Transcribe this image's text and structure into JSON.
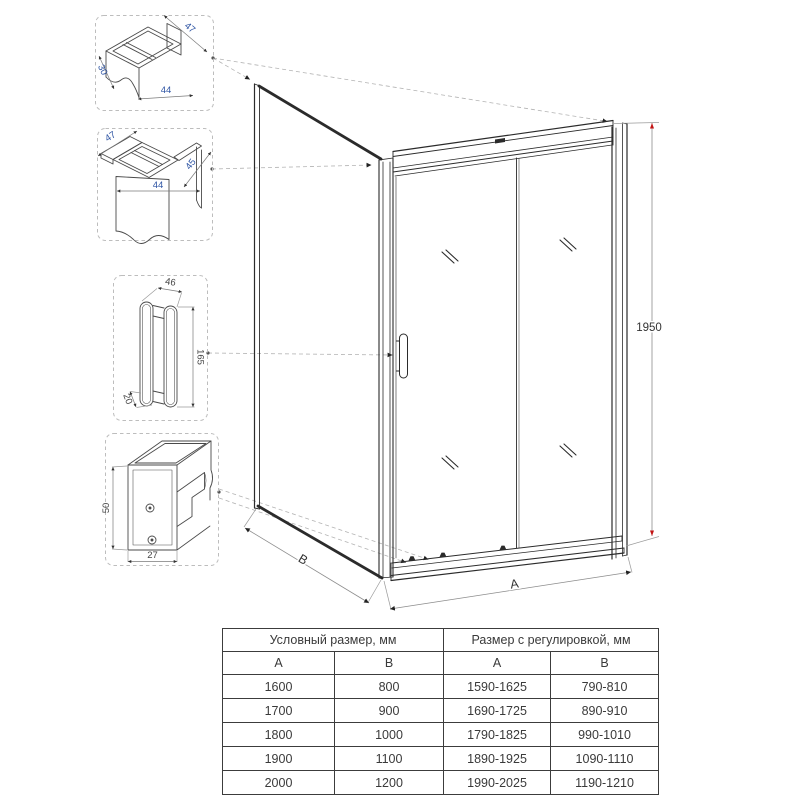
{
  "details": {
    "top_profile": {
      "dims": [
        "47",
        "30",
        "44"
      ]
    },
    "corner_profile": {
      "dims": [
        "47",
        "44",
        "45"
      ]
    },
    "handle": {
      "dims": [
        "46",
        "165",
        "20"
      ]
    },
    "bottom_rail": {
      "dims": [
        "50",
        "27"
      ]
    }
  },
  "drawing": {
    "height_label": "1950",
    "width_label": "A",
    "depth_label": "B",
    "accent_red": "#c41414",
    "line_color": "#2b2b2b",
    "dim_blue": "#2f55a4"
  },
  "table": {
    "group_headers": [
      "Условный размер, мм",
      "Размер с регулировкой, мм"
    ],
    "col_headers": [
      "A",
      "B",
      "A",
      "B"
    ],
    "rows": [
      [
        "1600",
        "800",
        "1590-1625",
        "790-810"
      ],
      [
        "1700",
        "900",
        "1690-1725",
        "890-910"
      ],
      [
        "1800",
        "1000",
        "1790-1825",
        "990-1010"
      ],
      [
        "1900",
        "1100",
        "1890-1925",
        "1090-1110"
      ],
      [
        "2000",
        "1200",
        "1990-2025",
        "1190-1210"
      ]
    ]
  }
}
